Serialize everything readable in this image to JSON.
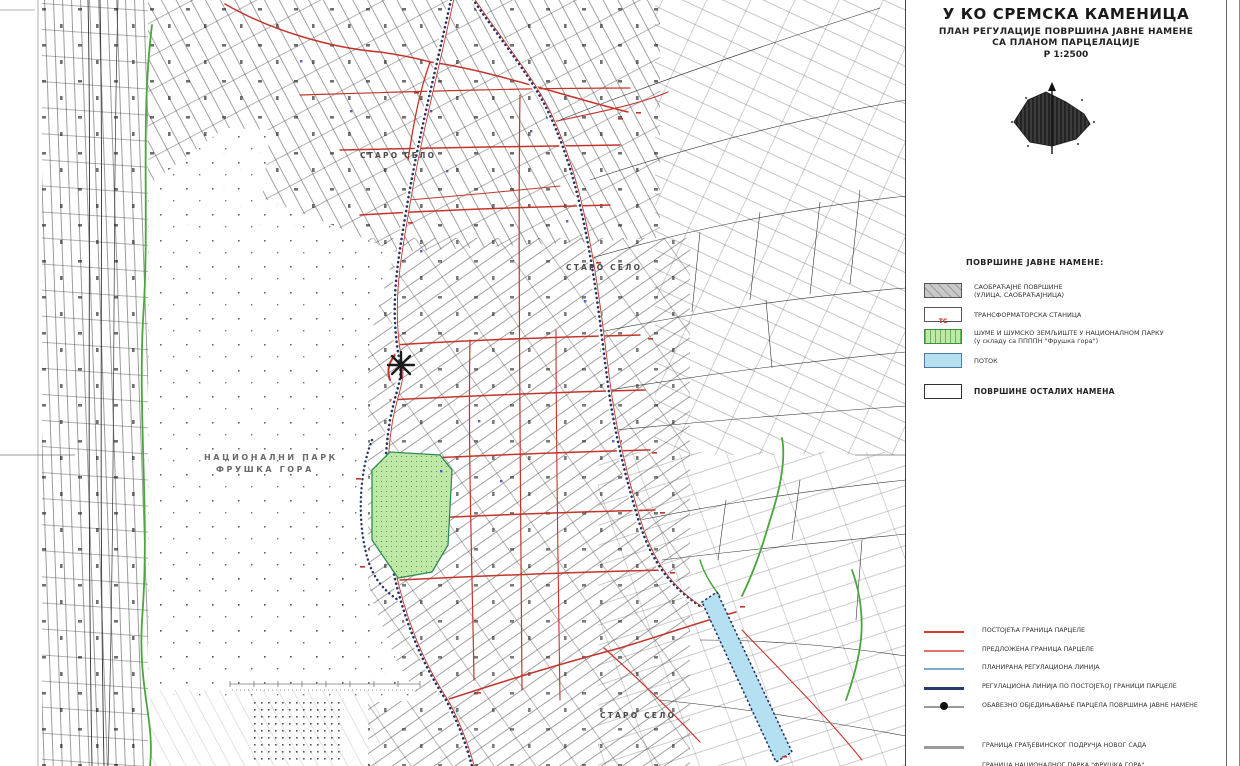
{
  "title": {
    "line1": "У КО СРЕМСКА КАМЕНИЦА",
    "line2": "ПЛАН РЕГУЛАЦИЈЕ ПОВРШИНА ЈАВНЕ НАМЕНЕ",
    "line3": "СА ПЛАНОМ ПАРЦЕЛАЦИЈЕ",
    "scale": "Р 1:2500"
  },
  "legend": {
    "public_heading": "ПОВРШИНЕ ЈАВНЕ НАМЕНЕ:",
    "items": [
      {
        "label": "САОБРАЋАЈНЕ ПОВРШИНЕ\n(УЛИЦА, САОБРАЋАЈНИЦА)",
        "swatch": "gray-hatch"
      },
      {
        "label": "ТРАНСФОРМАТОРСКА СТАНИЦА",
        "swatch": "ts-box",
        "swatch_text": "ТС"
      },
      {
        "label": "ШУМЕ И ШУМСКО ЗЕМЉИШТЕ У НАЦИОНАЛНОМ ПАРКУ\n(у складу са ППППН \"Фрушка гора\")",
        "swatch": "green-hatch"
      },
      {
        "label": "ПОТОК",
        "swatch": "blue-fill"
      }
    ],
    "other_heading": "ПОВРШИНЕ ОСТАЛИХ НАМЕНА",
    "lines": [
      {
        "label": "ПОСТОЈЕЋА ГРАНИЦА ПАРЦЕЛЕ",
        "style": "red-line"
      },
      {
        "label": "ПРЕДЛОЖЕНА ГРАНИЦА ПАРЦЕЛЕ",
        "style": "pink-line"
      },
      {
        "label": "ПЛАНИРАНА РЕГУЛАЦИОНА ЛИНИЈА",
        "style": "blue-line"
      },
      {
        "label": "РЕГУЛАЦИОНА ЛИНИЈА ПО ПОСТОЈЕЋОЈ ГРАНИЦИ ПАРЦЕЛЕ",
        "style": "navy-line"
      },
      {
        "label": "ОБАВЕЗНО ОБЈЕДИЊАВАЊЕ ПАРЦЕЛА ПОВРШИНА ЈАВНЕ НАМЕНЕ",
        "style": "dot-line"
      },
      {
        "label": "ГРАНИЦА ГРАЂЕВИНСКОГ ПОДРУЧЈА НОВОГ САДА",
        "style": "gray-line"
      },
      {
        "label": "ГРАНИЦА НАЦИОНАЛНОГ ПАРКА \"ФРУШКА ГОРА\"",
        "style": "green-dash-line"
      }
    ]
  },
  "map_labels": {
    "staro_selo_top": "СТАРО СЕЛО",
    "staro_selo_mid": "СТАРО СЕЛО",
    "staro_selo_bottom": "СТАРО СЕЛО",
    "park_line1": "НАЦИОНАЛНИ ПАРК",
    "park_line2": "ФРУШКА ГОРА"
  },
  "colors": {
    "existing_parcel_red": "#cf3b34",
    "proposed_parcel_pink": "#e2716c",
    "regulation_blue": "#7fa8cc",
    "regulation_navy": "#2a3a6e",
    "park_green": "#49a53c",
    "forest_fill": "#bfe8a6",
    "stream_fill": "#b5e0f2",
    "traffic_gray": "#c9c9c9"
  }
}
